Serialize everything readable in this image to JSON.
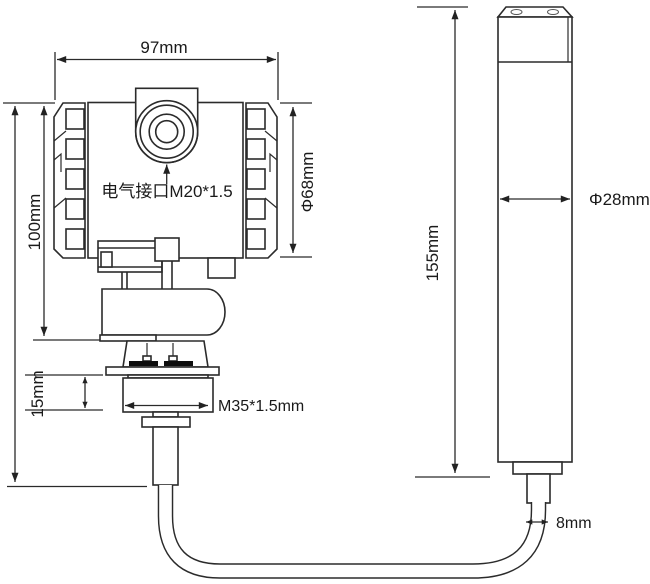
{
  "diagram": {
    "kind": "engineering-dimension-drawing",
    "background": "#ffffff",
    "line_color": "#2b2b2b",
    "text_color": "#1a1a1a",
    "labels": {
      "top_width": "97mm",
      "left_height": "100mm",
      "electrical_interface": "电气接口M20*1.5",
      "housing_diameter": "Φ68mm",
      "nut_height": "15mm",
      "mounting_thread": "M35*1.5mm",
      "probe_length": "155mm",
      "probe_diameter": "Φ28mm",
      "cable_diameter": "8mm"
    }
  }
}
